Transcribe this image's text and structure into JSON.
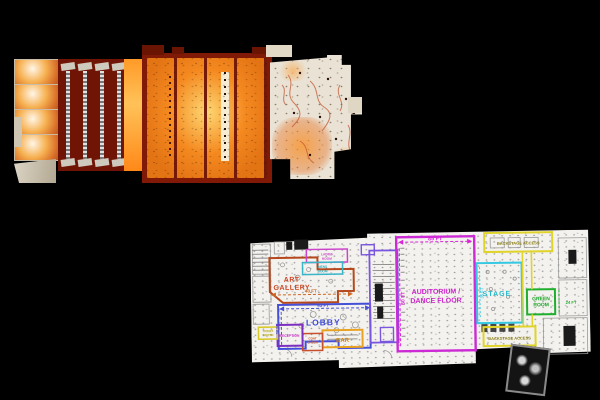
{
  "scene": {
    "background": "#000000"
  },
  "scan_view": {
    "palette": {
      "deep_red": "#701505",
      "frame_red": "#801a06",
      "bright_orange": "#ff9a28",
      "glow_yellow": "#ffc258",
      "pale_surface": "#e9e2d5",
      "vein_red": "#c2562e"
    }
  },
  "floor_plan": {
    "palette": {
      "paper": "#f4f2ee",
      "detail_gray": "#999999"
    },
    "rooms": {
      "art_gallery": {
        "lines": [
          "ART",
          "GALLERY"
        ],
        "color": "#cc4422",
        "outline": "#b5481c"
      },
      "lobby": {
        "lines": [
          "LOBBY"
        ],
        "color": "#3d4ad8",
        "outline": "#4450d8"
      },
      "auditorium": {
        "lines": [
          "AUDITORIUM /",
          "DANCE FLOOR"
        ],
        "color": "#cc22cc",
        "outline": "#cc2ad4"
      },
      "stage": {
        "lines": [
          "STAGE"
        ],
        "color": "#22b8cc",
        "outline": "#35c8e2"
      },
      "green_room": {
        "lines": [
          "GREEN",
          "ROOM"
        ],
        "color": "#17a326",
        "outline": "#1fae2e"
      },
      "bar": {
        "lines": [
          "BAR"
        ],
        "color": "#dd8800",
        "outline": "#e8a325"
      },
      "reception": {
        "lines": [
          "RECEPTION"
        ],
        "color": "#cc22cc",
        "outline": "#7d2fc0"
      },
      "ticket_booth": {
        "lines": [
          "TICKET",
          "BOOTH"
        ],
        "color": "#b0a010",
        "outline": "#d8c822"
      },
      "coat_check": {
        "lines": [
          "COAT",
          "CHECK"
        ],
        "color": "#c8502c",
        "outline": "#c8502c"
      },
      "ladies_room": {
        "lines": [
          "LADIES",
          "ROOM"
        ],
        "color": "#cc44cc",
        "outline": "#cc44cc"
      },
      "mens_room": {
        "lines": [
          "MENS",
          "ROOM"
        ],
        "color": "#2ba8bc",
        "outline": "#38b6c8"
      },
      "backstage_top": {
        "lines": [
          "BACKSTAGE ACCESS"
        ],
        "color": "#8a7d10",
        "outline": "#e0d42a"
      },
      "backstage_bottom": {
        "lines": [
          "BACKSTAGE ACCESS"
        ],
        "color": "#8a7d10",
        "outline": "#e0d42a"
      }
    },
    "dimensions": [
      {
        "text": "85 FT",
        "color": "#dd22dd"
      },
      {
        "text": "60 FT",
        "color": "#dd22dd"
      },
      {
        "text": "45 FT",
        "color": "#4450d8"
      },
      {
        "text": "30 FT",
        "color": "#4450d8"
      },
      {
        "text": "40 FT",
        "color": "#cc6622"
      },
      {
        "text": "35 FT",
        "color": "#35c8e2"
      },
      {
        "text": "24 FT",
        "color": "#1fae2e"
      }
    ]
  }
}
